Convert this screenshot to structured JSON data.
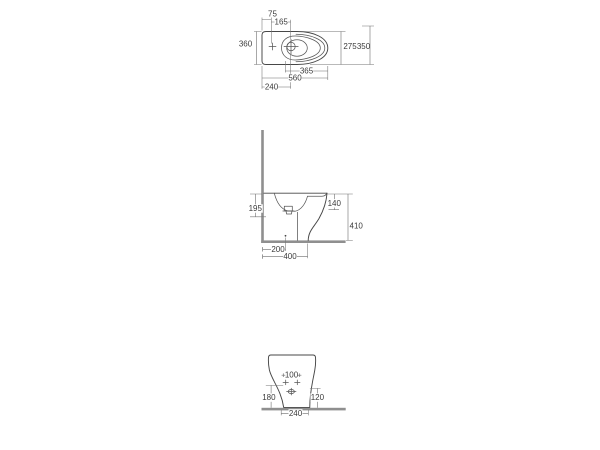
{
  "drawing": {
    "subject": "floor-standing bidet technical dimension drawing, three orthographic views",
    "units": "mm",
    "colors": {
      "background": "#ffffff",
      "outline": "#474747",
      "dimension_lines": "#6e6e6e",
      "wall_floor": "#8f8f8f",
      "label_text": "#3b3b3b"
    },
    "views": {
      "plan": {
        "label": "top view",
        "dims": {
          "d75": "75",
          "d165": "165",
          "d360": "360",
          "d275": "275",
          "d350": "350",
          "d365": "365",
          "d560": "560",
          "d240": "240"
        }
      },
      "side": {
        "label": "side elevation",
        "dims": {
          "d195": "195",
          "d140": "140",
          "d410": "410",
          "d200": "200",
          "d400": "400"
        }
      },
      "front": {
        "label": "front elevation",
        "dims": {
          "d100": "100",
          "d180": "180",
          "d120": "120",
          "d240": "240"
        }
      }
    }
  }
}
